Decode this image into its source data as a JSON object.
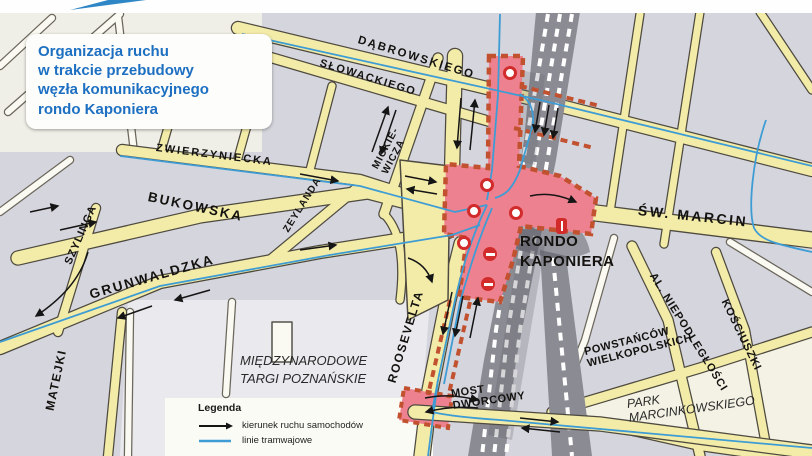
{
  "title": {
    "text": "Organizacja ruchu\nw trakcie przebudowy\nwęzła komunikacyjnego\nrondo Kaponiera"
  },
  "legend": {
    "heading": "Legenda",
    "items": [
      {
        "icon": "car-direction-arrow-icon",
        "label": "kierunek ruchu samochodów"
      },
      {
        "icon": "tram-line-icon",
        "label": "linie tramwajowe"
      }
    ]
  },
  "labels": {
    "dabrowskiego": "DĄBROWSKIEGO",
    "slowackiego": "SŁOWACKIEGO",
    "zwierzyniecka": "ZWIERZYNIECKA",
    "bukowska": "BUKOWSKA",
    "zeylanda": "ZEYLANDA",
    "mickiewicza": "MICKIE-\nWICZA",
    "szylinga": "SZYLINGA",
    "grunwaldzka": "GRUNWALDZKA",
    "matejki": "MATEJKI",
    "roosevelta": "ROOSEVELTA",
    "sw_marcin": "ŚW. MARCIN",
    "al_niepodleglosci": "AL. NIEPODLEGŁOŚCI",
    "kosciuszki": "KOŚCIUSZKI",
    "powstancow": "POWSTAŃCÓW\nWIELKOPOLSKICH",
    "park_marcinkowskiego": "PARK\nMARCINKOWSKIEGO",
    "most_dworcowy": "MOST\nDWORCOWY",
    "mtp": "MIĘDZYNARODOWE\nTARGI POZNAŃSKIE",
    "rondo_kaponiera": "RONDO\nKAPONIERA"
  },
  "colors": {
    "title_blue": "#1d6fc2",
    "road_yellow": "#f3eca9",
    "construction_pink": "#ee8190",
    "barrier_orange": "#c2512f",
    "tram_blue": "#3e9cd4",
    "railway_gray": "#8b8b94",
    "map_background": "#d5d5dd"
  }
}
